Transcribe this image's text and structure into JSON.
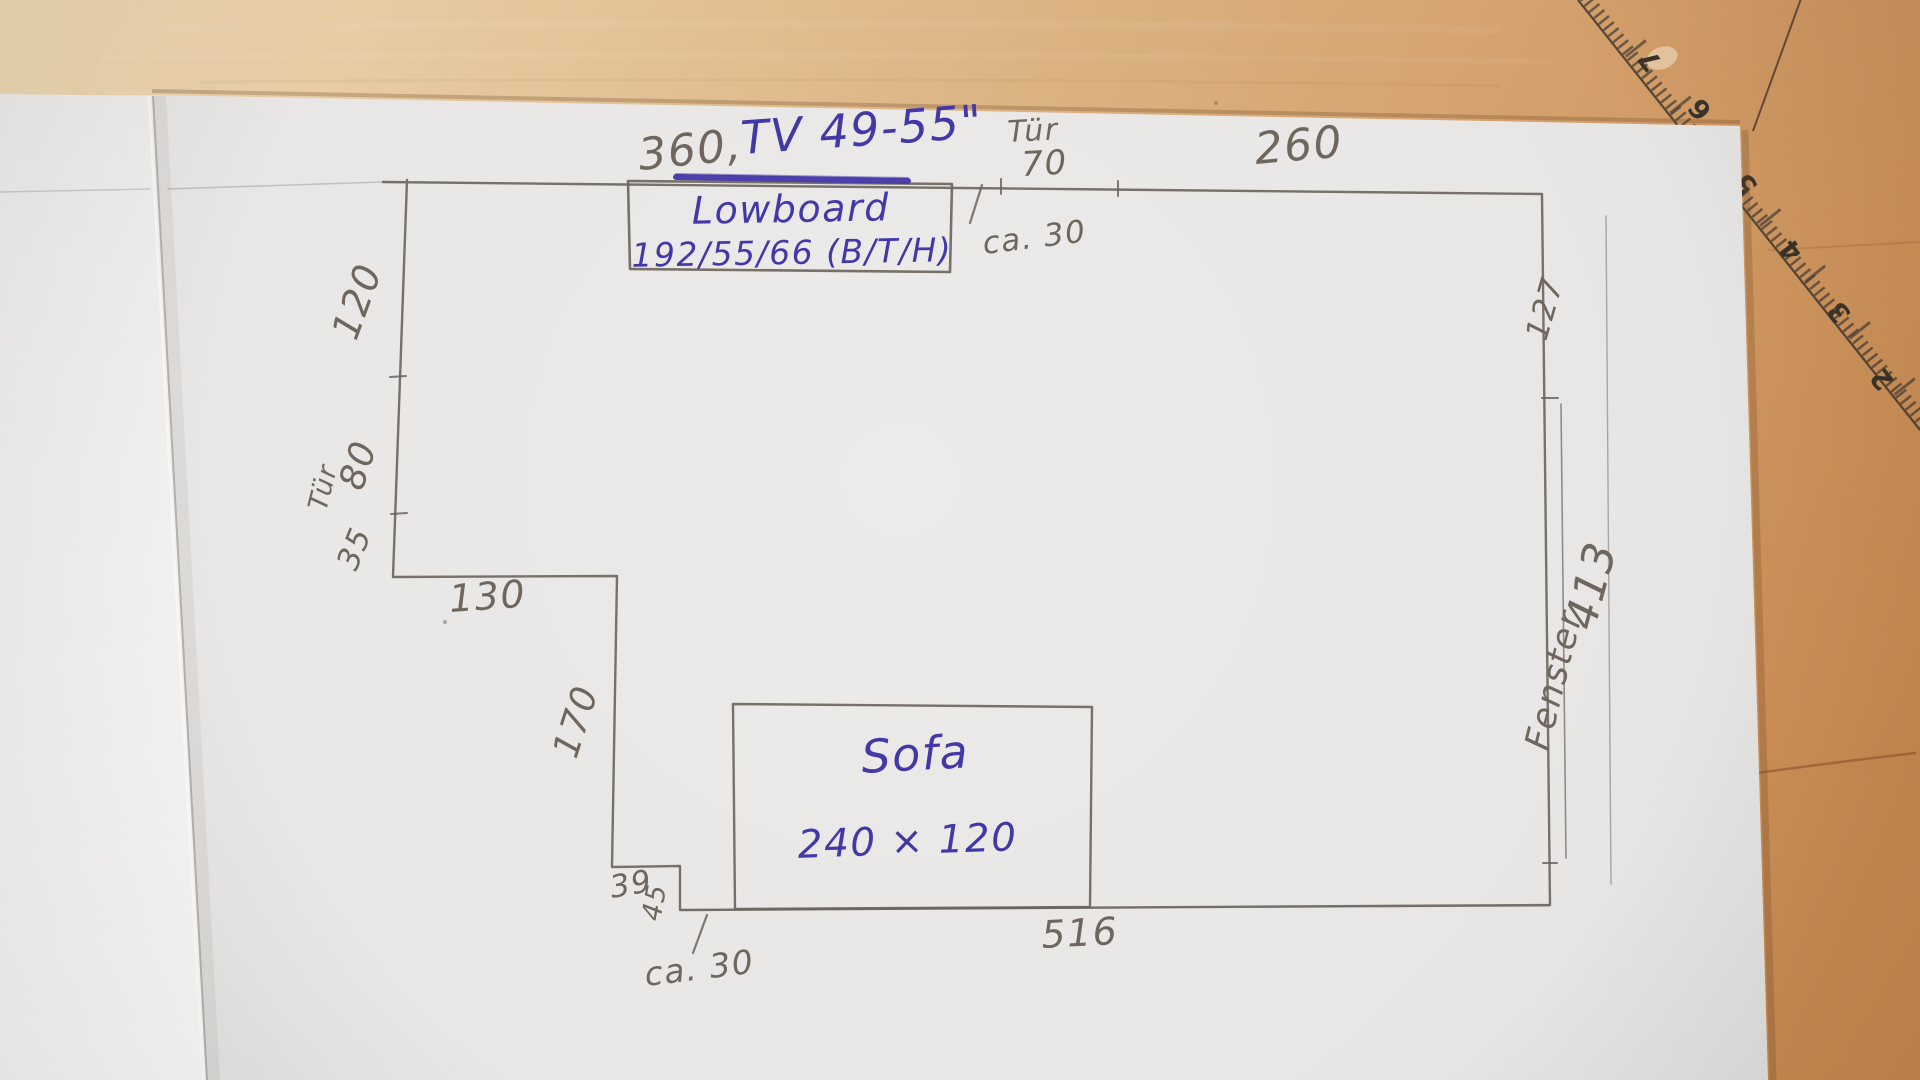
{
  "labels": {
    "len_top_left": "360,",
    "tv": "TV 49-55\"",
    "door_top_name": "Tür",
    "door_top_size": "70",
    "len_top_right": "260",
    "gap_top": "ca. 30",
    "left_seg1": "120",
    "door_left_name": "Tür",
    "door_left_size": "80",
    "left_seg2": "35",
    "step_top": "130",
    "left_seg3": "170",
    "nook_w": "39",
    "nook_h": "45",
    "gap_bottom": "ca. 30",
    "len_bottom": "516",
    "right_seg1": "127",
    "window_name": "Fenster",
    "window_len": "413"
  },
  "furniture": {
    "lowboard_name": "Lowboard",
    "lowboard_dims": "192/55/66 (B/T/H)",
    "sofa_name": "Sofa",
    "sofa_dims": "240 × 120"
  },
  "ruler_numbers": [
    "7",
    "6",
    "5",
    "4",
    "3",
    "2"
  ],
  "colors": {
    "ink": "#4338a8",
    "pencil": "#6f675e",
    "paper": "#e8e6e4",
    "left_page": "#f2f1ef",
    "wood": "#d9a96f"
  }
}
